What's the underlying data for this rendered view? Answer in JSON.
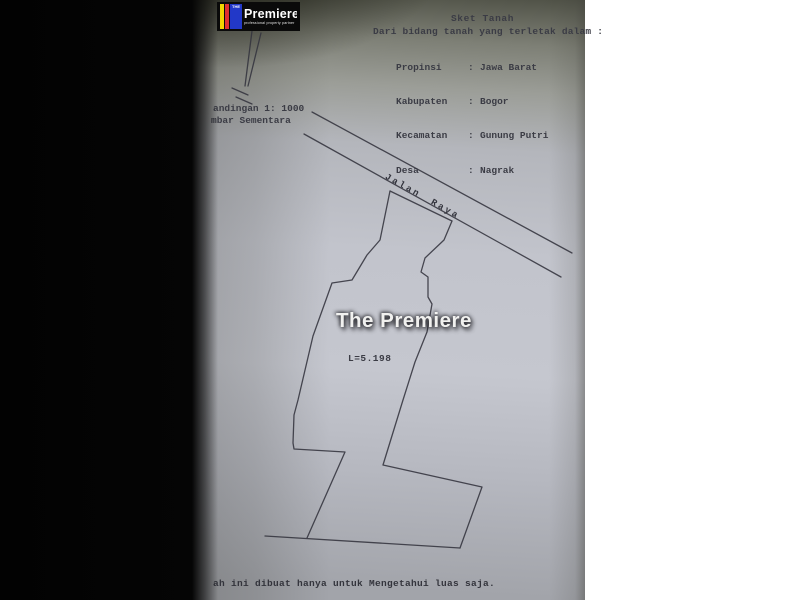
{
  "logo": {
    "prefix": "THE",
    "name": "Premiere",
    "tagline": "professional property partner"
  },
  "header": {
    "title": "Sket Tanah",
    "subtitle": "Dari bidang tanah yang terletak dalam :",
    "fields": [
      {
        "label": "Propinsi",
        "colon": ":",
        "value": "Jawa Barat"
      },
      {
        "label": "Kabupaten",
        "colon": ":",
        "value": "Bogor"
      },
      {
        "label": "Kecamatan",
        "colon": ":",
        "value": "Gunung Putri"
      },
      {
        "label": "Desa",
        "colon": ":",
        "value": "Nagrak"
      }
    ]
  },
  "side_note": {
    "line1": "andingan 1: 1000",
    "line2": "mbar Sementara"
  },
  "plot": {
    "road_label": "Jalan Raya",
    "area_label": "L=5.198"
  },
  "watermark": "The Premiere",
  "footer": {
    "note": "ah ini dibuat hanya untuk Mengetahui luas saja."
  },
  "colors": {
    "paper_light": "#c5c7cf",
    "paper_dark_top": "#4f5146",
    "sketch_line": "#34343e",
    "logo_blue": "#2238c8",
    "logo_red": "#e03030",
    "logo_yellow": "#f2d500"
  }
}
